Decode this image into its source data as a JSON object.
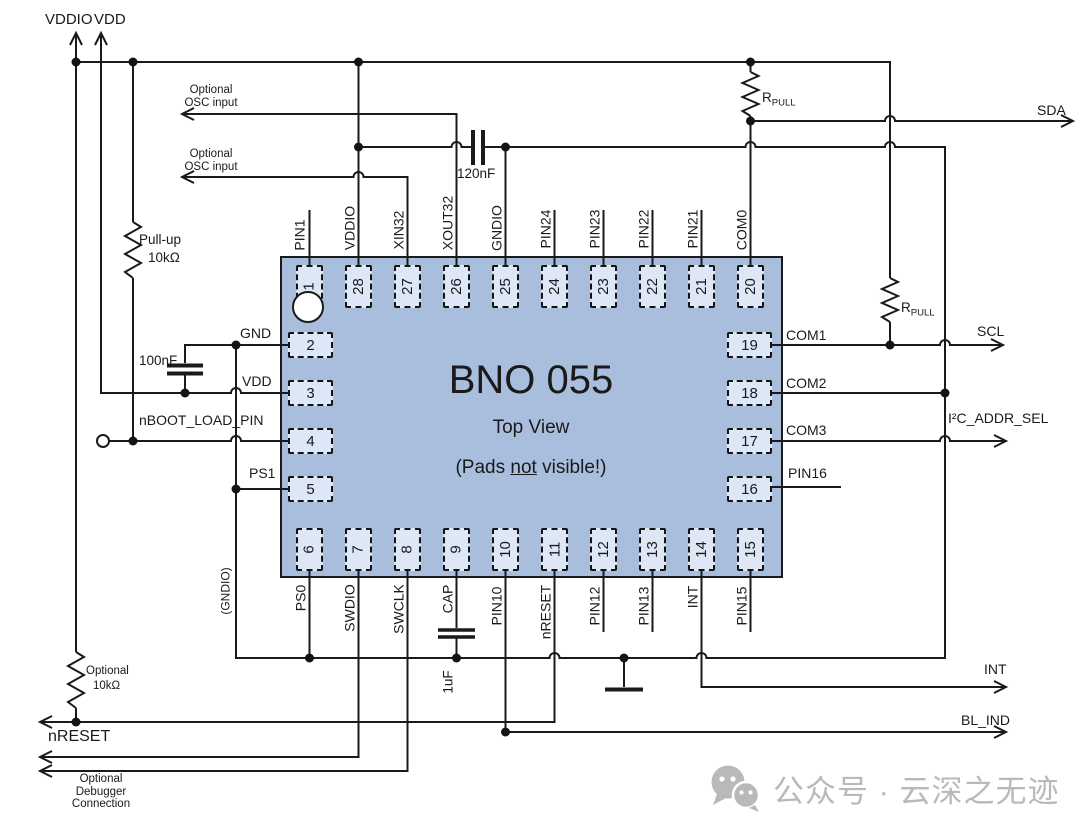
{
  "chip": {
    "name": "BNO 055",
    "view": "Top View",
    "note": {
      "prefix": "(Pads ",
      "underlined": "not",
      "suffix": " visible!)"
    },
    "pads_top": [
      "1",
      "28",
      "27",
      "26",
      "25",
      "24",
      "23",
      "22",
      "21",
      "20"
    ],
    "pads_bottom": [
      "6",
      "7",
      "8",
      "9",
      "10",
      "11",
      "12",
      "13",
      "14",
      "15"
    ],
    "pads_left": [
      "2",
      "3",
      "4",
      "5"
    ],
    "pads_right": [
      "19",
      "18",
      "17",
      "16"
    ]
  },
  "pins": {
    "top": {
      "pin1": "PIN1",
      "vddio": "VDDIO",
      "xin32": "XIN32",
      "xout32": "XOUT32",
      "gndio": "GNDIO",
      "pin24": "PIN24",
      "pin23": "PIN23",
      "pin22": "PIN22",
      "pin21": "PIN21",
      "com0": "COM0"
    },
    "bottom": {
      "ps0": "PS0",
      "swdio": "SWDIO",
      "swclk": "SWCLK",
      "cap": "CAP",
      "pin10": "PIN10",
      "nreset": "nRESET",
      "pin12": "PIN12",
      "pin13": "PIN13",
      "int": "INT",
      "pin15": "PIN15"
    },
    "left": {
      "gnd": "GND",
      "vdd": "VDD",
      "nboot": "nBOOT_LOAD_PIN",
      "ps1": "PS1"
    },
    "right": {
      "com1": "COM1",
      "com2": "COM2",
      "com3": "COM3",
      "pin16": "PIN16"
    },
    "gndio_note": "(GNDIO)"
  },
  "power": {
    "vddio": "VDDIO",
    "vdd": "VDD"
  },
  "signals": {
    "sda": "SDA",
    "scl": "SCL",
    "i2c_addr_sel": "I²C_ADDR_SEL",
    "int": "INT",
    "bl_ind": "BL_IND",
    "nreset": "nRESET"
  },
  "components": {
    "pullup": {
      "name": "Pull-up",
      "value": "10kΩ"
    },
    "cap_100nf": "100nF",
    "cap_120nf": "120nF",
    "cap_1uf": "1uF",
    "rpull": {
      "base": "R",
      "sub": "PULL"
    },
    "optional_pullup": {
      "line1": "Optional",
      "line2": "10kΩ"
    }
  },
  "notes": {
    "osc1": {
      "line1": "Optional",
      "line2": "OSC input"
    },
    "osc2": {
      "line1": "Optional",
      "line2": "OSC input"
    },
    "debugger": {
      "line1": "Optional",
      "line2": "Debugger",
      "line3": "Connection"
    }
  },
  "watermark": {
    "text": "公众号 · 云深之无迹"
  },
  "colors": {
    "chip_body": "#a9bedd",
    "pad_fill": "#dde7f5",
    "wire": "#1a1a1a",
    "watermark": "#b9b9b9"
  }
}
